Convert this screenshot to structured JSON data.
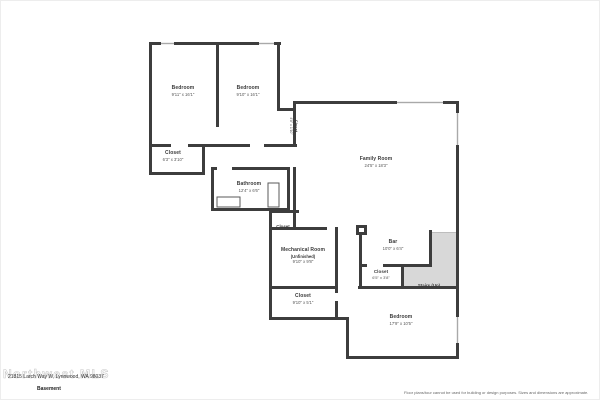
{
  "page": {
    "wall_color": "#3d3d3d",
    "window_color": "#a9a9a9",
    "stairs_fill": "#d8d8d8",
    "background": "#ffffff"
  },
  "rooms": [
    {
      "name": "Bedroom",
      "dims": "9'11\" x 16'1\""
    },
    {
      "name": "Bedroom",
      "dims": "9'10\" x 16'1\""
    },
    {
      "name": "Closet",
      "dims": "4'8\" x 1'10\""
    },
    {
      "name": "Closet",
      "dims": "6'3\" x 3'10\""
    },
    {
      "name": "Bathroom",
      "dims": "12'4\" x 6'6\""
    },
    {
      "name": "Closet",
      "dims": ""
    },
    {
      "name": "Family Room",
      "dims": "24'5\" x 18'3\""
    },
    {
      "name": "Mechanical Room",
      "sub": "(Unfinished)",
      "dims": "9'10\" x 9'8\""
    },
    {
      "name": "Bar",
      "dims": "10'0\" x 6'4\""
    },
    {
      "name": "Closet",
      "dims": "6'5\" x 3'8\""
    },
    {
      "name": "Stairs (Up)",
      "dims": ""
    },
    {
      "name": "Closet",
      "dims": "9'10\" x 5'1\""
    },
    {
      "name": "Bedroom",
      "dims": "17'9\" x 10'5\""
    }
  ],
  "footer": {
    "address": "21815 Larch Way W, Lynnwood, WA 98037",
    "floor_label": "Basement",
    "watermark": "Northwest MLS",
    "disclaimer": "Floor plans/tour cannot be used for building or design purposes. Sizes and dimensions are approximate."
  }
}
